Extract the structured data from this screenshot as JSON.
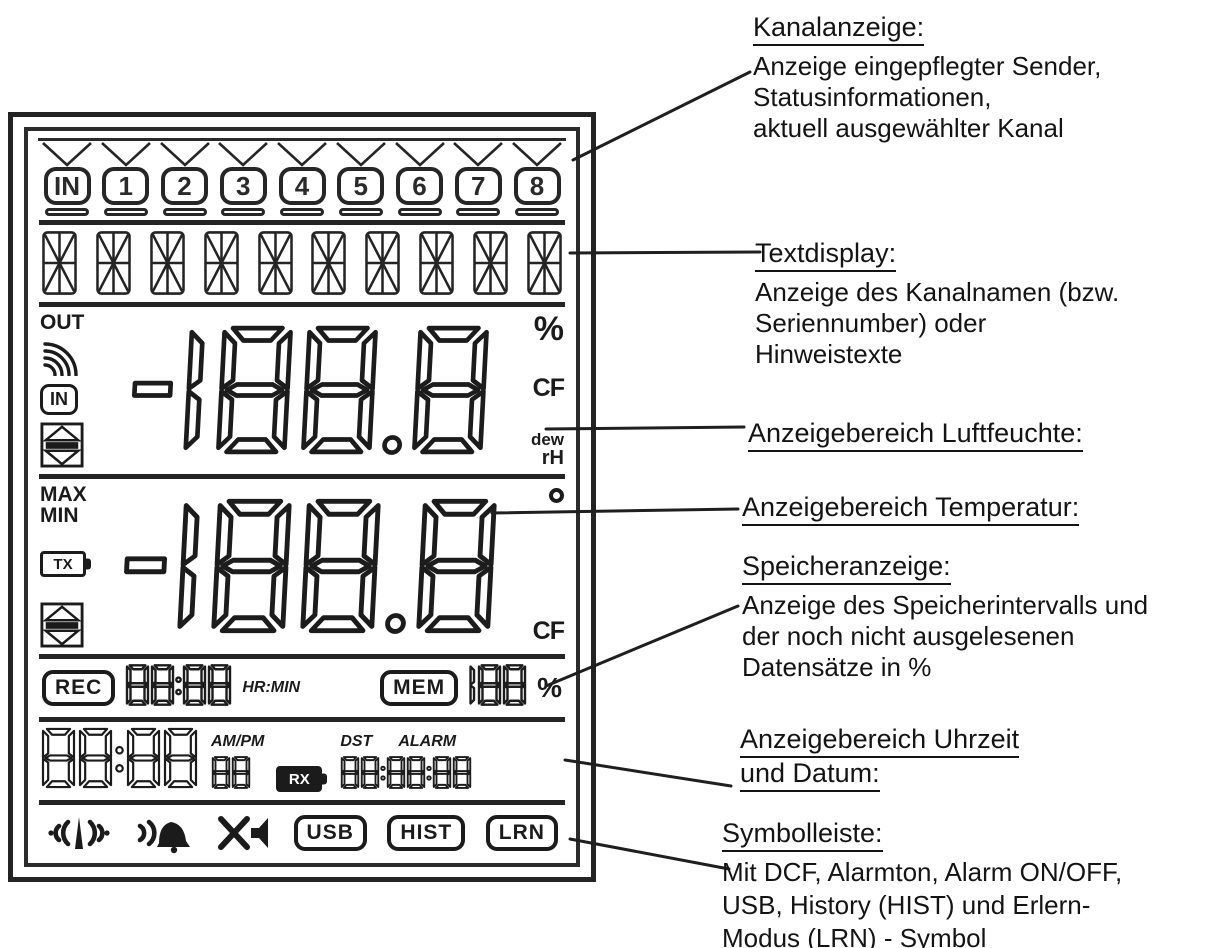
{
  "diagram": {
    "annotations": [
      {
        "title": "Kanalanzeige:",
        "lines": [
          "Anzeige eingepflegter Sender,",
          "Statusinformationen,",
          "aktuell ausgewählter Kanal"
        ]
      },
      {
        "title": "Textdisplay:",
        "lines": [
          "Anzeige des Kanalnamen (bzw.",
          "Seriennumber) oder",
          "Hinweistexte"
        ]
      },
      {
        "title": "Anzeigebereich Luftfeuchte:",
        "lines": []
      },
      {
        "title": "Anzeigebereich Temperatur:",
        "lines": []
      },
      {
        "title": "Speicheranzeige:",
        "lines": [
          "Anzeige des Speicherintervalls und",
          "der noch nicht ausgelesenen",
          "Datensätze in %"
        ]
      },
      {
        "title": "Anzeigebereich Uhrzeit",
        "title2": "und Datum:",
        "lines": []
      },
      {
        "title": "Symbolleiste:",
        "lines": [
          "Mit DCF, Alarmton, Alarm ON/OFF,",
          "USB, History (HIST) und Erlern-",
          "Modus (LRN) - Symbol"
        ]
      }
    ]
  },
  "lcd": {
    "channels": [
      "IN",
      "1",
      "2",
      "3",
      "4",
      "5",
      "6",
      "7",
      "8"
    ],
    "textdisplay": {
      "char_count": 10
    },
    "humidity": {
      "out_label": "OUT",
      "in_label": "IN",
      "value": "-188.8",
      "percent": "%",
      "cf": "CF",
      "dew": "dew",
      "rh": "rH"
    },
    "temperature": {
      "max_label": "MAX",
      "min_label": "MIN",
      "tx_label": "TX",
      "value": "-188.8",
      "cf": "CF"
    },
    "memory": {
      "rec_label": "REC",
      "interval": "88:88",
      "hrmin_label": "HR:MIN",
      "mem_label": "MEM",
      "datasets": "188",
      "percent": "%"
    },
    "clock": {
      "time": "88:88",
      "ampm_label": "AM/PM",
      "seconds": "88",
      "rx_label": "RX",
      "dst_label": "DST",
      "alarm_label": "ALARM",
      "date": "88:88:88"
    },
    "symbols": {
      "icons": [
        "dcf-signal",
        "alarm-tone",
        "alarm-muted"
      ],
      "usb": "USB",
      "hist": "HIST",
      "lrn": "LRN"
    }
  },
  "colors": {
    "ink": "#1b1b1b",
    "background": "#ffffff"
  }
}
